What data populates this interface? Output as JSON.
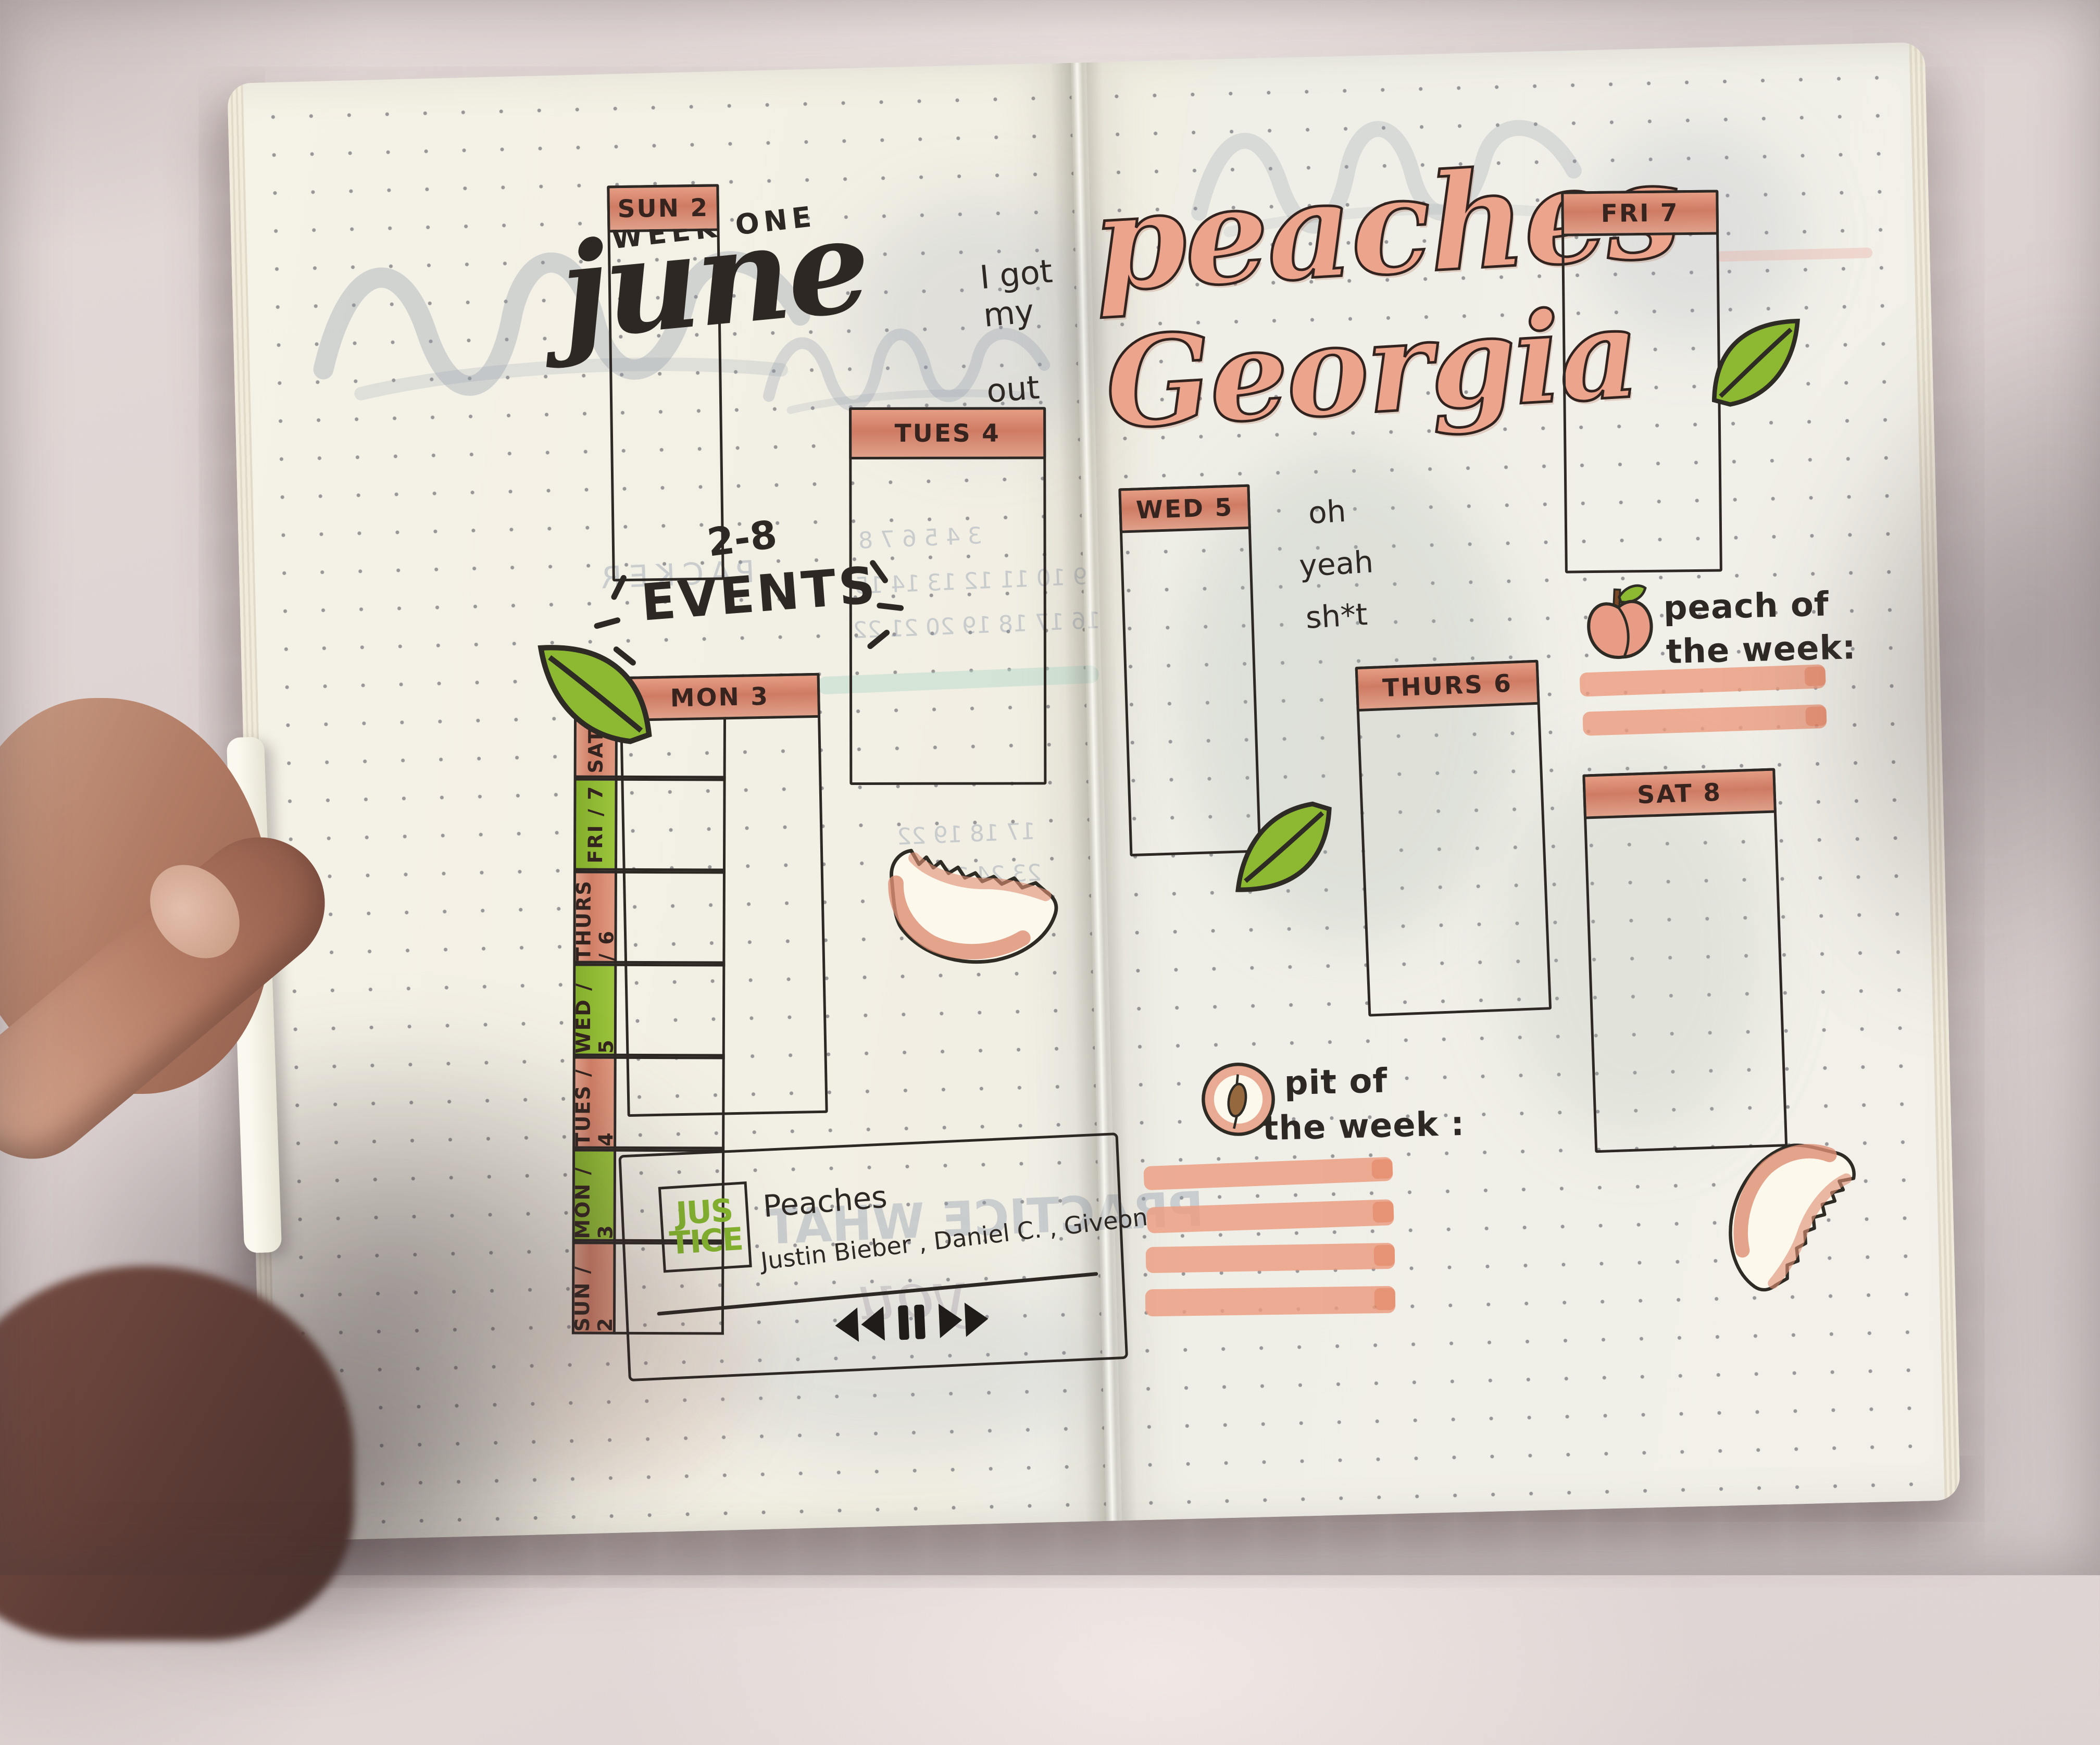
{
  "photo": {
    "subject": "hand holding an open bullet journal weekly spread on fabric"
  },
  "left_page": {
    "week_label": "WEEK ONE",
    "month": "june",
    "date_range": "2-8",
    "events_title": "EVENTS",
    "note_top_1": "I got my",
    "note_top_2": "out in",
    "sidebar_days": [
      {
        "label": "SAT / 8",
        "color": "#dd8c72"
      },
      {
        "label": "FRI / 7",
        "color": "#94bd37"
      },
      {
        "label": "THURS / 6",
        "color": "#dd8c72"
      },
      {
        "label": "WED / 5",
        "color": "#94bd37"
      },
      {
        "label": "TUES / 4",
        "color": "#dd8c72"
      },
      {
        "label": "MON / 3",
        "color": "#94bd37"
      },
      {
        "label": "SUN / 2",
        "color": "#dd8c72"
      }
    ],
    "boxes": {
      "sun": "SUN 2",
      "tues": "TUES 4",
      "mon": "MON 3"
    },
    "player": {
      "album_art_line1": "JUS",
      "album_art_line2": "TICE",
      "song_title": "Peaches",
      "artists": "Justin Bieber , Daniel C. , Giveon"
    },
    "ghost": {
      "packer": "PACKER",
      "practice": "PRACTICE WHAT",
      "you": "you",
      "cal_row1": "3 4 5 6 7 8",
      "cal_row2": "9 10 11 12 13 14 15",
      "cal_row3": "16 17 18 19 20 21 22",
      "cal_row4": "17 18 19 22",
      "cal_row5": "23 24 26 27",
      "cal_row6": "30"
    }
  },
  "right_page": {
    "title_word1": "peaches",
    "title_word2": "Georgia",
    "note_1": "oh",
    "note_2": "yeah",
    "note_3": "sh*t",
    "boxes": {
      "wed": "WED 5",
      "thurs": "THURS 6",
      "fri": "FRI 7",
      "sat": "SAT 8"
    },
    "peach_of_week_1": "peach of",
    "peach_of_week_2": "the week:",
    "pit_of_week_1": "pit of",
    "pit_of_week_2": "the week :"
  },
  "colors": {
    "salmon_header": "#dd8c72",
    "green_tab": "#94bd37",
    "highlight_bar": "#eb9c80",
    "ink": "#2e2824",
    "script_fill": "#eca48d",
    "album_green": "#85b62e",
    "page_cream": "#f2f0e6"
  }
}
